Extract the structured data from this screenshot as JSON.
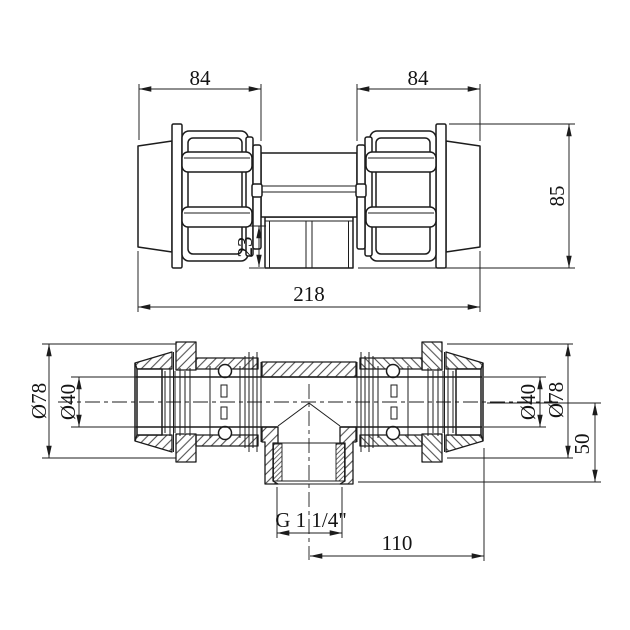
{
  "page": {
    "background": "#ffffff",
    "line_color": "#1c1c1c"
  },
  "views": {
    "front": {
      "dims": {
        "width_left": "84",
        "width_right": "84",
        "height": "85",
        "branch_stub": "23",
        "overall_length": "218"
      }
    },
    "section": {
      "dims": {
        "outer_diameter_left": "Ø78",
        "bore_diameter_left": "Ø40",
        "bore_diameter_right": "Ø40",
        "outer_diameter_right": "Ø78",
        "branch_depth": "50",
        "thread_size": "G 1 1/4\"",
        "branch_center_to_end": "110"
      }
    }
  }
}
